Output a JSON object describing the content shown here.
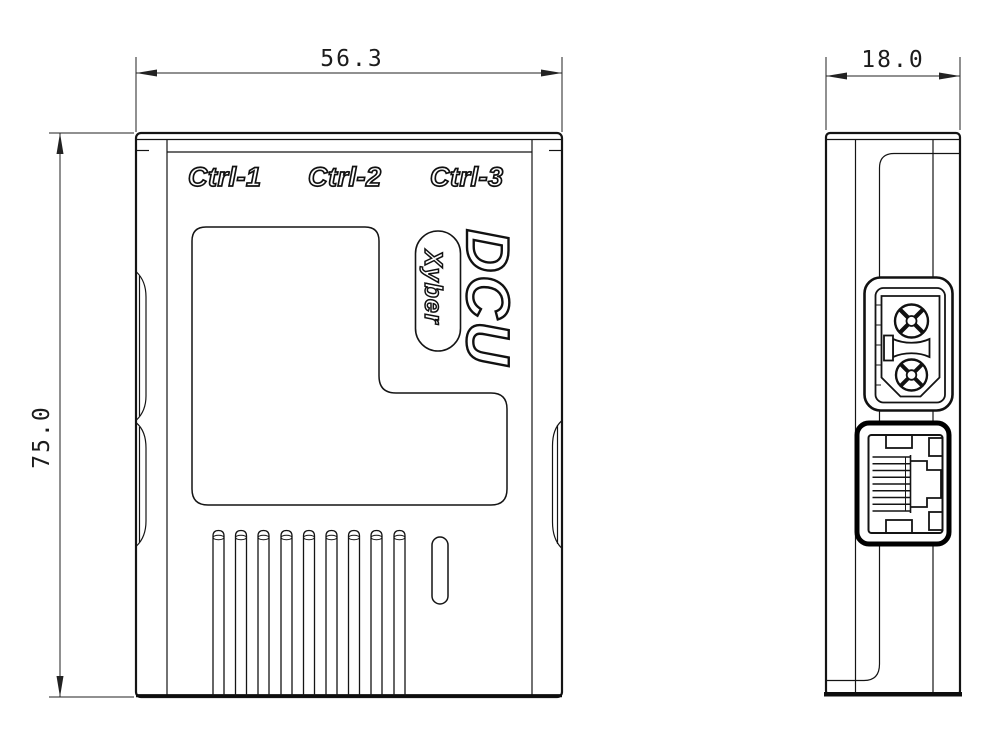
{
  "drawing": {
    "front_view": {
      "dim_width": "56.3",
      "dim_height": "75.0",
      "port_labels": [
        "Ctrl-1",
        "Ctrl-2",
        "Ctrl-3"
      ],
      "product_name": "DCU",
      "brand_badge": "Xyber"
    },
    "side_view": {
      "dim_depth": "18.0"
    },
    "colors": {
      "line": "#141414",
      "background": "#ffffff"
    }
  }
}
